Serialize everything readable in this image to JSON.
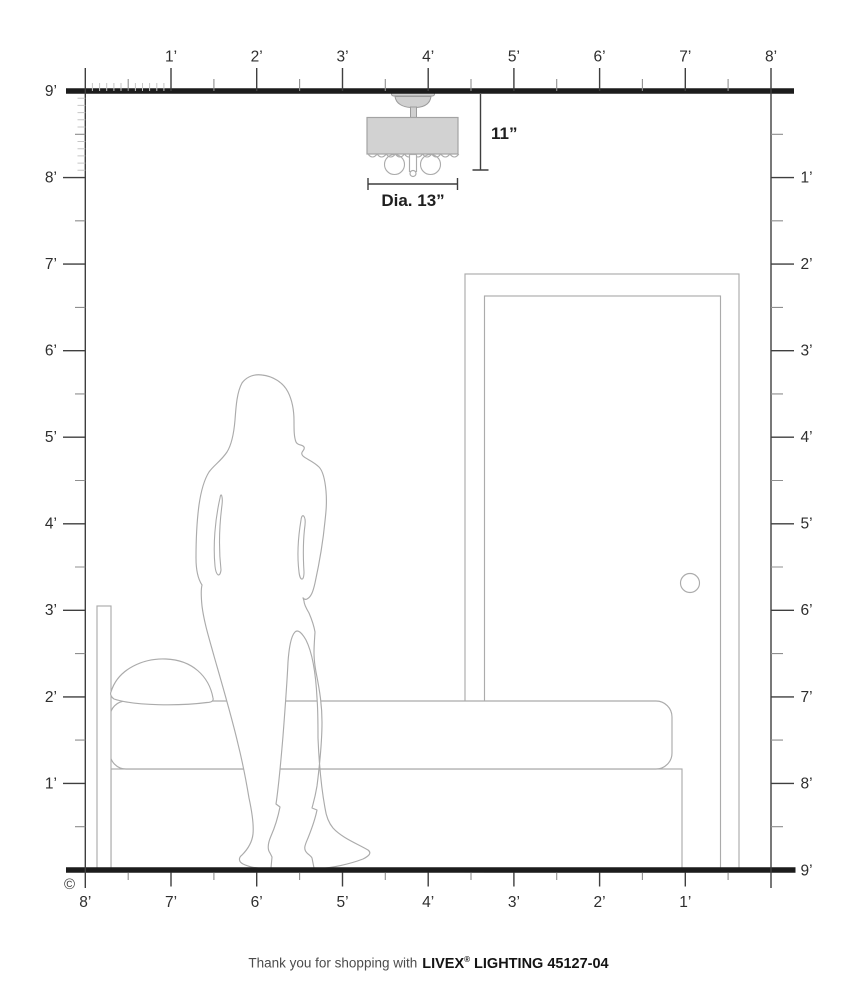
{
  "colors": {
    "wall_line": "#1c1c1c",
    "tick_major": "#3f3f3f",
    "tick_half": "#8f8f8f",
    "tick_inch": "#c6c6c6",
    "sketch_outline": "#ababab",
    "shade_fill": "#d2d2d2",
    "dimension_line": "#3e3e3e",
    "label_text": "#2e2e2e"
  },
  "rulers": {
    "top": {
      "labels": [
        "1’",
        "2’",
        "3’",
        "4’",
        "5’",
        "6’",
        "7’",
        "8’"
      ]
    },
    "left": {
      "labels": [
        "9’",
        "8’",
        "7’",
        "6’",
        "5’",
        "4’",
        "3’",
        "2’",
        "1’"
      ]
    },
    "right": {
      "labels": [
        "1’",
        "2’",
        "3’",
        "4’",
        "5’",
        "6’",
        "7’",
        "8’",
        "9’"
      ]
    },
    "bottom": {
      "labels": [
        "8’",
        "7’",
        "6’",
        "5’",
        "4’",
        "3’",
        "2’",
        "1’"
      ]
    }
  },
  "fixture": {
    "height_label": "11”",
    "diameter_label": "Dia. 13”"
  },
  "copyright": "©",
  "footer": {
    "prefix": "Thank you for shopping with",
    "brand": "LIVEX",
    "registered": "®",
    "model": "LIGHTING 45127-04"
  }
}
